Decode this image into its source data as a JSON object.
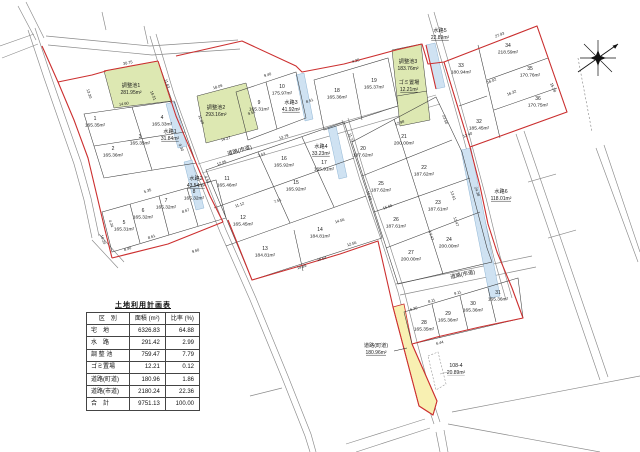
{
  "table": {
    "title": "土地利用計画表",
    "headers": {
      "category": "区　別",
      "area": "面積 (m²)",
      "ratio": "比率 (%)"
    },
    "rows": [
      {
        "category": "宅　地",
        "area": "6326.83",
        "ratio": "64.88"
      },
      {
        "category": "水　路",
        "area": "291.42",
        "ratio": "2.99"
      },
      {
        "category": "調 整 池",
        "area": "759.47",
        "ratio": "7.79"
      },
      {
        "category": "ゴミ置場",
        "area": "12.21",
        "ratio": "0.12"
      },
      {
        "category": "道路(町道)",
        "area": "180.96",
        "ratio": "1.86"
      },
      {
        "category": "道路(市道)",
        "area": "2180.24",
        "ratio": "22.36"
      },
      {
        "category": "合　計",
        "area": "9751.13",
        "ratio": "100.00"
      }
    ]
  },
  "map": {
    "icons": {
      "north": "north-compass-star-icon"
    },
    "lots": [
      {
        "no": "1",
        "area": "165.35m²",
        "x": 95,
        "y": 122
      },
      {
        "no": "2",
        "area": "165.36m²",
        "x": 113,
        "y": 152
      },
      {
        "no": "3",
        "area": "165.35m²",
        "x": 140,
        "y": 140
      },
      {
        "no": "4",
        "area": "165.33m²",
        "x": 162,
        "y": 121
      },
      {
        "no": "5",
        "area": "165.31m²",
        "x": 124,
        "y": 226
      },
      {
        "no": "6",
        "area": "165.32m²",
        "x": 143,
        "y": 214
      },
      {
        "no": "7",
        "area": "165.32m²",
        "x": 166,
        "y": 204
      },
      {
        "no": "8",
        "area": "165.32m²",
        "x": 194,
        "y": 195
      },
      {
        "no": "9",
        "area": "165.31m²",
        "x": 259,
        "y": 106
      },
      {
        "no": "10",
        "area": "175.97m²",
        "x": 282,
        "y": 90
      },
      {
        "no": "11",
        "area": "165.46m²",
        "x": 227,
        "y": 182
      },
      {
        "no": "12",
        "area": "165.45m²",
        "x": 243,
        "y": 221
      },
      {
        "no": "13",
        "area": "184.81m²",
        "x": 265,
        "y": 252
      },
      {
        "no": "14",
        "area": "184.81m²",
        "x": 320,
        "y": 233
      },
      {
        "no": "15",
        "area": "165.92m²",
        "x": 296,
        "y": 186
      },
      {
        "no": "16",
        "area": "165.92m²",
        "x": 284,
        "y": 162
      },
      {
        "no": "17",
        "area": "165.91m²",
        "x": 324,
        "y": 166
      },
      {
        "no": "18",
        "area": "165.36m²",
        "x": 337,
        "y": 94
      },
      {
        "no": "19",
        "area": "165.37m²",
        "x": 374,
        "y": 84
      },
      {
        "no": "20",
        "area": "187.62m²",
        "x": 363,
        "y": 152
      },
      {
        "no": "21",
        "area": "200.00m²",
        "x": 404,
        "y": 140
      },
      {
        "no": "22",
        "area": "187.62m²",
        "x": 424,
        "y": 171
      },
      {
        "no": "23",
        "area": "187.61m²",
        "x": 438,
        "y": 206
      },
      {
        "no": "24",
        "area": "200.00m²",
        "x": 449,
        "y": 243
      },
      {
        "no": "25",
        "area": "187.62m²",
        "x": 381,
        "y": 187
      },
      {
        "no": "26",
        "area": "187.61m²",
        "x": 396,
        "y": 223
      },
      {
        "no": "27",
        "area": "200.00m²",
        "x": 411,
        "y": 256
      },
      {
        "no": "28",
        "area": "165.35m²",
        "x": 424,
        "y": 326
      },
      {
        "no": "29",
        "area": "165.36m²",
        "x": 448,
        "y": 317
      },
      {
        "no": "30",
        "area": "165.36m²",
        "x": 473,
        "y": 307
      },
      {
        "no": "31",
        "area": "165.36m²",
        "x": 498,
        "y": 296
      },
      {
        "no": "32",
        "area": "185.45m²",
        "x": 479,
        "y": 125
      },
      {
        "no": "33",
        "area": "180.94m²",
        "x": 461,
        "y": 69
      },
      {
        "no": "34",
        "area": "218.59m²",
        "x": 508,
        "y": 49
      },
      {
        "no": "35",
        "area": "170.76m²",
        "x": 530,
        "y": 72
      },
      {
        "no": "36",
        "area": "170.75m²",
        "x": 538,
        "y": 102
      }
    ],
    "features": [
      {
        "name": "水路1",
        "area": "31.84m²",
        "x": 170,
        "y": 134,
        "underline": true
      },
      {
        "name": "水路2",
        "area": "43.54m²",
        "x": 196,
        "y": 181,
        "underline": true
      },
      {
        "name": "水路3",
        "area": "41.92m²",
        "x": 291,
        "y": 105,
        "underline": true
      },
      {
        "name": "水路4",
        "area": "33.23m²",
        "x": 321,
        "y": 149,
        "underline": true
      },
      {
        "name": "水路5",
        "area": "22.89m²",
        "x": 440,
        "y": 33,
        "underline": true
      },
      {
        "name": "水路6",
        "area": "118.01m²",
        "x": 501,
        "y": 194,
        "underline": true
      },
      {
        "name": "調整池1",
        "area": "281.95m²",
        "x": 131,
        "y": 88
      },
      {
        "name": "調整池2",
        "area": "293.16m²",
        "x": 216,
        "y": 110
      },
      {
        "name": "調整池3",
        "area": "183.76m²",
        "x": 408,
        "y": 64
      },
      {
        "name": "ゴミ置場",
        "area": "12.21m²",
        "x": 409,
        "y": 85,
        "underline": true
      },
      {
        "name": "道路(町道)",
        "area": "180.96m²",
        "x": 376,
        "y": 348,
        "underline": true
      },
      {
        "name": "108-4",
        "area": "20.89m²",
        "x": 456,
        "y": 368,
        "underline": true,
        "muted": true
      }
    ],
    "road_labels": [
      {
        "label": "道路(市道)",
        "x": 240,
        "y": 152,
        "rot": -16
      },
      {
        "label": "道路(市道)",
        "x": 463,
        "y": 276,
        "rot": -12
      }
    ],
    "dimensions": [
      {
        "t": "30.75",
        "x": 128,
        "y": 64,
        "r": -12
      },
      {
        "t": "13.30",
        "x": 88,
        "y": 94,
        "r": 72
      },
      {
        "t": "14.60",
        "x": 124,
        "y": 105,
        "r": -7
      },
      {
        "t": "11.63",
        "x": 166,
        "y": 84,
        "r": 70
      },
      {
        "t": "18.09",
        "x": 218,
        "y": 88,
        "r": -17
      },
      {
        "t": "14.27",
        "x": 226,
        "y": 140,
        "r": -17
      },
      {
        "t": "9.40",
        "x": 268,
        "y": 76,
        "r": -18
      },
      {
        "t": "8.51",
        "x": 310,
        "y": 102,
        "r": -18
      },
      {
        "t": "16.51",
        "x": 152,
        "y": 96,
        "r": 68
      },
      {
        "t": "11.80",
        "x": 200,
        "y": 120,
        "r": 68
      },
      {
        "t": "9.51",
        "x": 252,
        "y": 114,
        "r": -19
      },
      {
        "t": "13.79",
        "x": 284,
        "y": 138,
        "r": -18
      },
      {
        "t": "12.05",
        "x": 222,
        "y": 164,
        "r": -19
      },
      {
        "t": "7.53",
        "x": 262,
        "y": 156,
        "r": -19
      },
      {
        "t": "11.12",
        "x": 240,
        "y": 206,
        "r": -19
      },
      {
        "t": "8.61",
        "x": 152,
        "y": 238,
        "r": -19
      },
      {
        "t": "8.40",
        "x": 128,
        "y": 250,
        "r": -18
      },
      {
        "t": "16.24",
        "x": 102,
        "y": 240,
        "r": 70
      },
      {
        "t": "4.24",
        "x": 110,
        "y": 224,
        "r": 70
      },
      {
        "t": "9.60",
        "x": 196,
        "y": 252,
        "r": -18
      },
      {
        "t": "8.67",
        "x": 186,
        "y": 212,
        "r": -19
      },
      {
        "t": "5.35",
        "x": 148,
        "y": 192,
        "r": -19
      },
      {
        "t": "9.30",
        "x": 180,
        "y": 148,
        "r": 66
      },
      {
        "t": "12.98",
        "x": 400,
        "y": 124,
        "r": -19
      },
      {
        "t": "15.02",
        "x": 368,
        "y": 196,
        "r": 70
      },
      {
        "t": "13.61",
        "x": 452,
        "y": 196,
        "r": 70
      },
      {
        "t": "12.47",
        "x": 455,
        "y": 222,
        "r": 70
      },
      {
        "t": "17.47",
        "x": 430,
        "y": 236,
        "r": 70
      },
      {
        "t": "15.65",
        "x": 388,
        "y": 208,
        "r": -19
      },
      {
        "t": "19.89",
        "x": 302,
        "y": 268,
        "r": -16
      },
      {
        "t": "18.64",
        "x": 322,
        "y": 260,
        "r": -16
      },
      {
        "t": "12.56",
        "x": 352,
        "y": 245,
        "r": -16
      },
      {
        "t": "14.56",
        "x": 340,
        "y": 222,
        "r": -16
      },
      {
        "t": "23.50",
        "x": 444,
        "y": 120,
        "r": 70
      },
      {
        "t": "24.38",
        "x": 476,
        "y": 192,
        "r": 70
      },
      {
        "t": "27.93",
        "x": 500,
        "y": 36,
        "r": -21
      },
      {
        "t": "15.28",
        "x": 552,
        "y": 88,
        "r": 65
      },
      {
        "t": "16.02",
        "x": 492,
        "y": 82,
        "r": -21
      },
      {
        "t": "16.32",
        "x": 512,
        "y": 94,
        "r": -21
      },
      {
        "t": "12.40",
        "x": 468,
        "y": 136,
        "r": -21
      },
      {
        "t": "8.11",
        "x": 432,
        "y": 302,
        "r": -16
      },
      {
        "t": "9.11",
        "x": 458,
        "y": 294,
        "r": -16
      },
      {
        "t": "6.44",
        "x": 440,
        "y": 344,
        "r": -14
      },
      {
        "t": "6.30",
        "x": 414,
        "y": 310,
        "r": -16
      },
      {
        "t": "4.25",
        "x": 356,
        "y": 62,
        "r": -16
      },
      {
        "t": "11.73",
        "x": 350,
        "y": 138,
        "r": 70
      },
      {
        "t": "4.50",
        "x": 206,
        "y": 180,
        "r": 66
      },
      {
        "t": "7.51",
        "x": 278,
        "y": 202,
        "r": -19
      }
    ]
  },
  "colors": {
    "boundary_red": "#cc2f2f",
    "pond_green": "#dde8b2",
    "water_blue": "#cfe2f2",
    "road_yellow": "#f8f0b2",
    "muted_gray": "#999999"
  }
}
